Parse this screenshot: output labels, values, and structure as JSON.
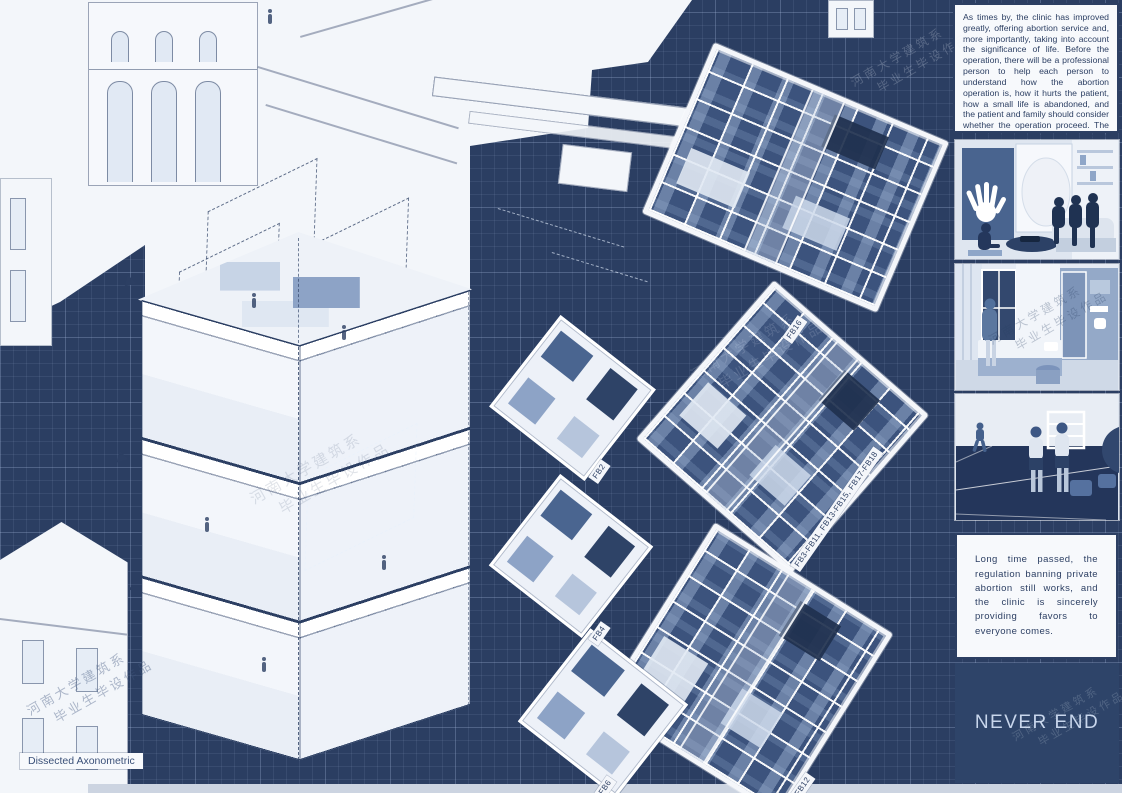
{
  "board": {
    "colors": {
      "background": "#2b3e62",
      "paper": "#f3f6fa",
      "ink": "#2c3f63",
      "light_text": "#c8d6ec",
      "plan_fill": "#3c537d"
    }
  },
  "axonometric": {
    "caption": "Dissected Axonometric"
  },
  "plans": {
    "large": [
      {
        "id": "plan-fb16",
        "label": "FB16"
      },
      {
        "id": "plan-fb3-fb18",
        "label": "FB3-FB11, FB13-FB15, FB17-FB18"
      },
      {
        "id": "plan-fb12",
        "label": "FB12"
      }
    ],
    "small": [
      {
        "id": "plan-fb2",
        "label": "FB2"
      },
      {
        "id": "plan-fb4",
        "label": "FB4"
      },
      {
        "id": "plan-fb6",
        "label": "FB6"
      }
    ]
  },
  "sidebar": {
    "intro_text": "As times by, the clinic has improved greatly, offering abortion service and, more importantly, taking into account the significance of life. Before the operation, there will be a professional person to help each person to understand how the abortion operation is, how it hurts the patient, how a small life is abandoned, and the patient and family should consider whether the operation proceed. The patient's psychological and physical care is also taken into consideration after the operation, and each patient will receive the most comprehensive and professional care.",
    "panels": [
      {
        "icon": "counseling-scene"
      },
      {
        "icon": "patient-room-scene"
      },
      {
        "icon": "rehab-court-scene"
      }
    ],
    "outro_text": "Long time passed, the regulation banning private abortion still works, and the clinic is sincerely providing favors to everyone comes.",
    "never_end_label": "NEVER END"
  },
  "watermarks": {
    "line1": "河南大学建筑系",
    "line2": "毕业生毕设作品"
  }
}
